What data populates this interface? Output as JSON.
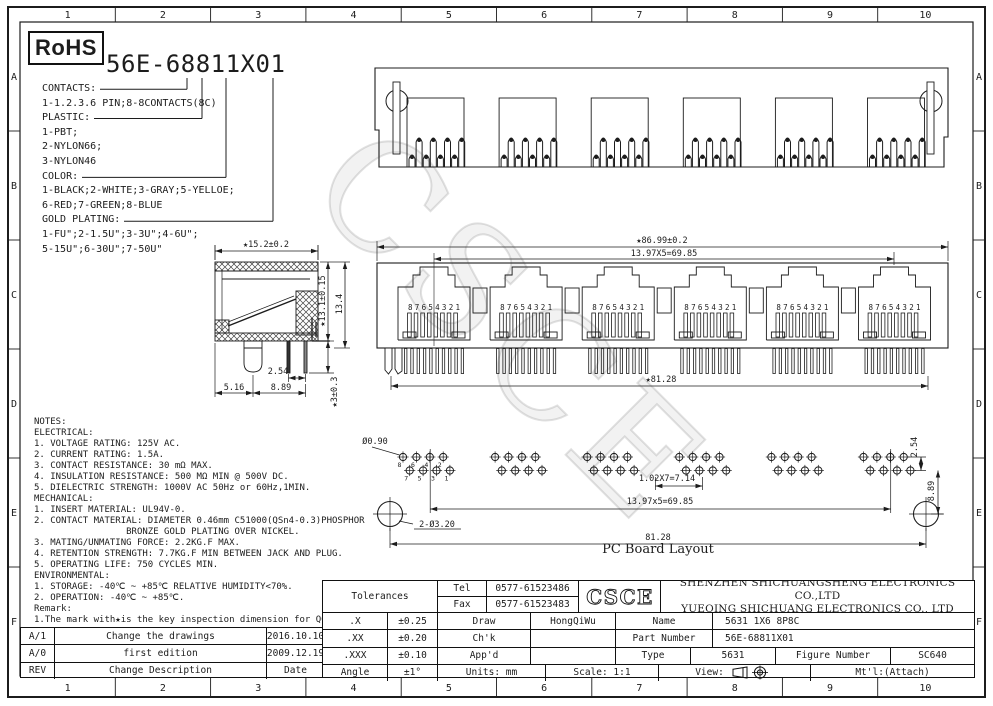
{
  "rohs": "RoHS",
  "watermark": "CSCE",
  "border": {
    "cols": [
      "1",
      "2",
      "3",
      "4",
      "5",
      "6",
      "7",
      "8",
      "9",
      "10"
    ],
    "rows": [
      "A",
      "B",
      "C",
      "D",
      "E",
      "F"
    ]
  },
  "ordering": {
    "part_number": "56E-68811X01",
    "options_text": "CONTACTS:\n1-1.2.3.6 PIN;8-8CONTACTS(8C)\nPLASTIC:\n1-PBT;\n2-NYLON66;\n3-NYLON46\nCOLOR:\n1-BLACK;2-WHITE;3-GRAY;5-YELLOE;\n6-RED;7-GREEN;8-BLUE\nGOLD PLATING:\n1-FU\";2-1.5U\";3-3U\";4-6U\";\n5-15U\";6-30U\";7-50U\""
  },
  "notes": {
    "text": "NOTES:\nELECTRICAL:\n1. VOLTAGE RATING: 125V AC.\n2. CURRENT RATING: 1.5A.\n3. CONTACT RESISTANCE: 30 mΩ MAX.\n4. INSULATION RESISTANCE: 500 MΩ MIN @ 500V DC.\n5. DIELECTRIC STRENGTH: 1000V AC 50Hz or 60Hz,1MIN.\nMECHANICAL:\n1. INSERT MATERIAL: UL94V-0.\n2. CONTACT MATERIAL: DIAMETER 0.46mm C51000(QSn4-0.3)PHOSPHOR\n                 BRONZE GOLD PLATING OVER NICKEL.\n3. MATING/UNMATING FORCE: 2.2KG.F MAX.\n4. RETENTION STRENGTH: 7.7KG.F MIN BETWEEN JACK AND PLUG.\n5. OPERATING LIFE: 750 CYCLES MIN.\nENVIRONMENTAL:\n1. STORAGE: -40℃ ~ +85℃ RELATIVE HUMIDITY<70%.\n2. OPERATION: -40℃ ~ +85℃.\nRemark:\n1.The mark with★is the key inspection dimension for QC"
  },
  "drawing": {
    "ports": 6,
    "pins_per_port": 8,
    "pin_numbers_front": "87654321",
    "pcb_pin_labels_top": [
      "8",
      "6",
      "4",
      "2"
    ],
    "pcb_pin_labels_bottom": [
      "7",
      "5",
      "3",
      "1"
    ],
    "pcb_caption": "PC Board Layout",
    "dims": {
      "front_width": "★86.99±0.2",
      "front_pitch": "13.97X5=69.85",
      "front_span": "★81.28",
      "side_width": "★15.2±0.2",
      "side_height_inner": "★13.1±0.15",
      "side_height_outer": "13.4",
      "side_pin_pitch": "2.54",
      "side_front_offset": "5.16",
      "side_pin_offset": "8.89",
      "side_standoff": "★3±0.3",
      "pcb_hole": "Ø0.90",
      "pcb_hole_pitch": "1.02X7=7.14",
      "pcb_group_pitch": "13.97x5=69.85",
      "pcb_span": "81.28",
      "pcb_mount_holes": "2-Ø3.20",
      "pcb_row_offset": "2.54",
      "pcb_mount_offset": "8.89"
    }
  },
  "revision_table": {
    "rows": [
      {
        "rev": "A/1",
        "description": "Change the drawings",
        "date": "2016.10.10"
      },
      {
        "rev": "A/0",
        "description": "first edition",
        "date": "2009.12.19"
      },
      {
        "rev": "REV",
        "description": "Change Description",
        "date": "Date"
      }
    ]
  },
  "title_block": {
    "tolerances_label": "Tolerances",
    "tolerances": [
      {
        "label": ".X",
        "value": "±0.25"
      },
      {
        "label": ".XX",
        "value": "±0.20"
      },
      {
        "label": ".XXX",
        "value": "±0.10"
      },
      {
        "label": "Angle",
        "value": "±1°"
      }
    ],
    "tel_label": "Tel",
    "tel": "0577-61523486",
    "fax_label": "Fax",
    "fax": "0577-61523483",
    "logo": "CSCE",
    "company_line1": "SHENZHEN SHICHUANGSHENG ELECTRONICS CO.,LTD",
    "company_line2": "YUEQING SHICHUANG ELECTRONICS CO., LTD",
    "draw_label": "Draw",
    "draw": "HongQiWu",
    "chk_label": "Ch'k",
    "chk": "",
    "appd_label": "App'd",
    "appd": "",
    "name_label": "Name",
    "name": "5631 1X6 8P8C",
    "part_number_label": "Part Number",
    "part_number": "56E-68811X01",
    "type_label": "Type",
    "type": "5631",
    "figure_number_label": "Figure Number",
    "figure_number": "SC640",
    "units": "Units: mm",
    "scale": "Scale: 1:1",
    "view_label": "View:",
    "mtl": "Mt'l:(Attach)"
  }
}
